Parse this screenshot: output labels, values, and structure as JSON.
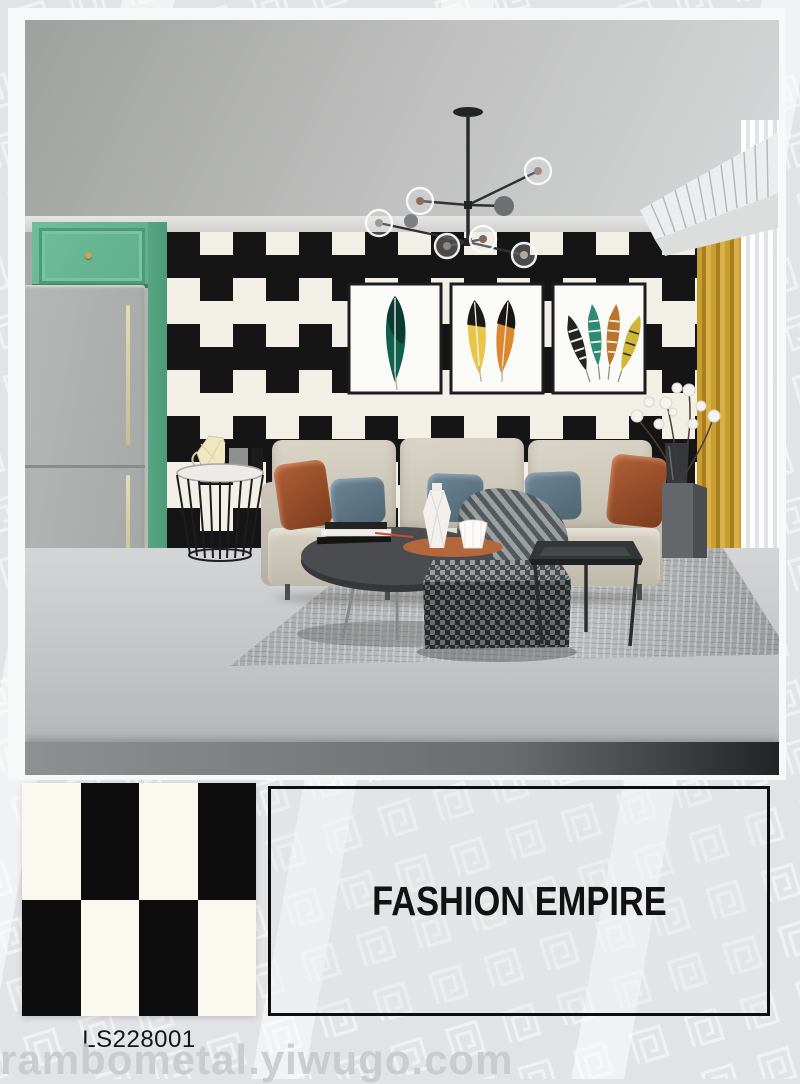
{
  "product": {
    "code": "LS228001",
    "brand": "FASHION EMPIRE"
  },
  "watermark": "rambometal.yiwugo.com",
  "swatch": {
    "rows": [
      [
        "#fbf8ef",
        "#0d0d0d",
        "#fbf8ef",
        "#0d0d0d"
      ],
      [
        "#0d0d0d",
        "#fbf8ef",
        "#0d0d0d",
        "#fbf8ef"
      ]
    ]
  },
  "scene": {
    "wallpaper_black": "#151515",
    "wallpaper_white": "#f2efe6",
    "cabinet_green": "#66b694",
    "curtain_gold": "#c59d32",
    "sofa_beige": "#cfc9ba",
    "pillow_rust": "#a2582f",
    "pillow_blue": "#67808f",
    "floor_gray": "#c5c7c9",
    "background_gray": "#e1e3e5"
  }
}
